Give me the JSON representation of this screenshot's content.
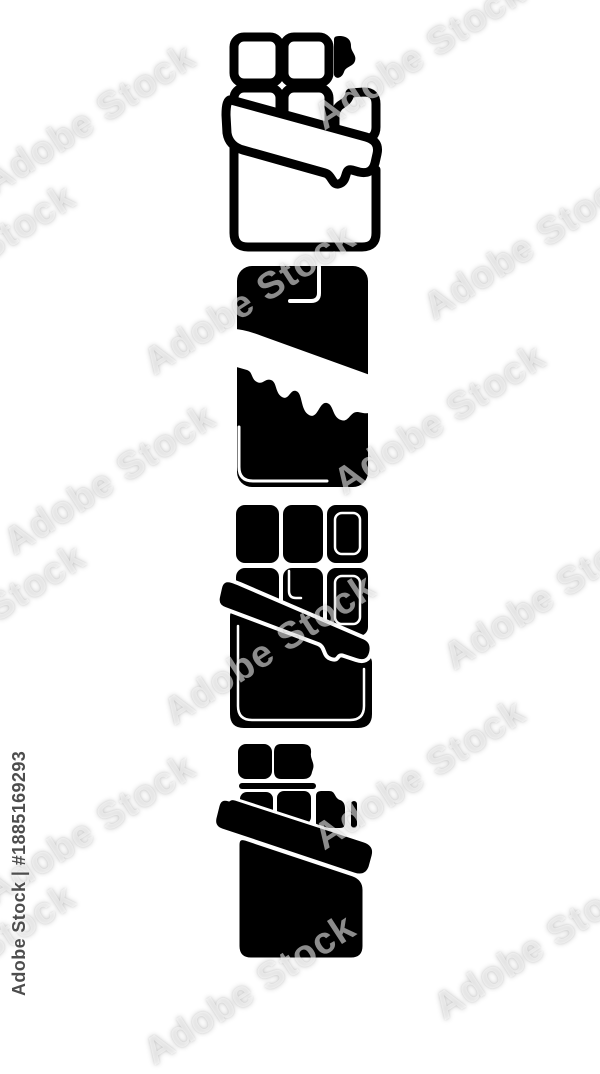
{
  "watermark": {
    "tile_text": "Adobe Stock",
    "id_label": "Adobe Stock | #1885169293",
    "tile_color": "rgba(255,255,255,0.55)",
    "id_text_color": "#4d4d4d"
  },
  "icons": [
    {
      "name": "chocolate-bar-open-outline-icon",
      "style": "outline",
      "description": "Opened chocolate bar in wrapper with bitten squares, outline style"
    },
    {
      "name": "chocolate-bar-melting-solid-icon",
      "style": "solid",
      "description": "Solid chocolate bar with melting dripping wrapper band"
    },
    {
      "name": "chocolate-bar-open-solid-icon",
      "style": "solid",
      "description": "Opened solid chocolate bar with square rows and wrapper band"
    },
    {
      "name": "chocolate-bar-open-small-solid-icon",
      "style": "solid",
      "description": "Small opened solid chocolate bar glyph"
    }
  ],
  "colors": {
    "icon": "#000000",
    "background": "#ffffff"
  }
}
